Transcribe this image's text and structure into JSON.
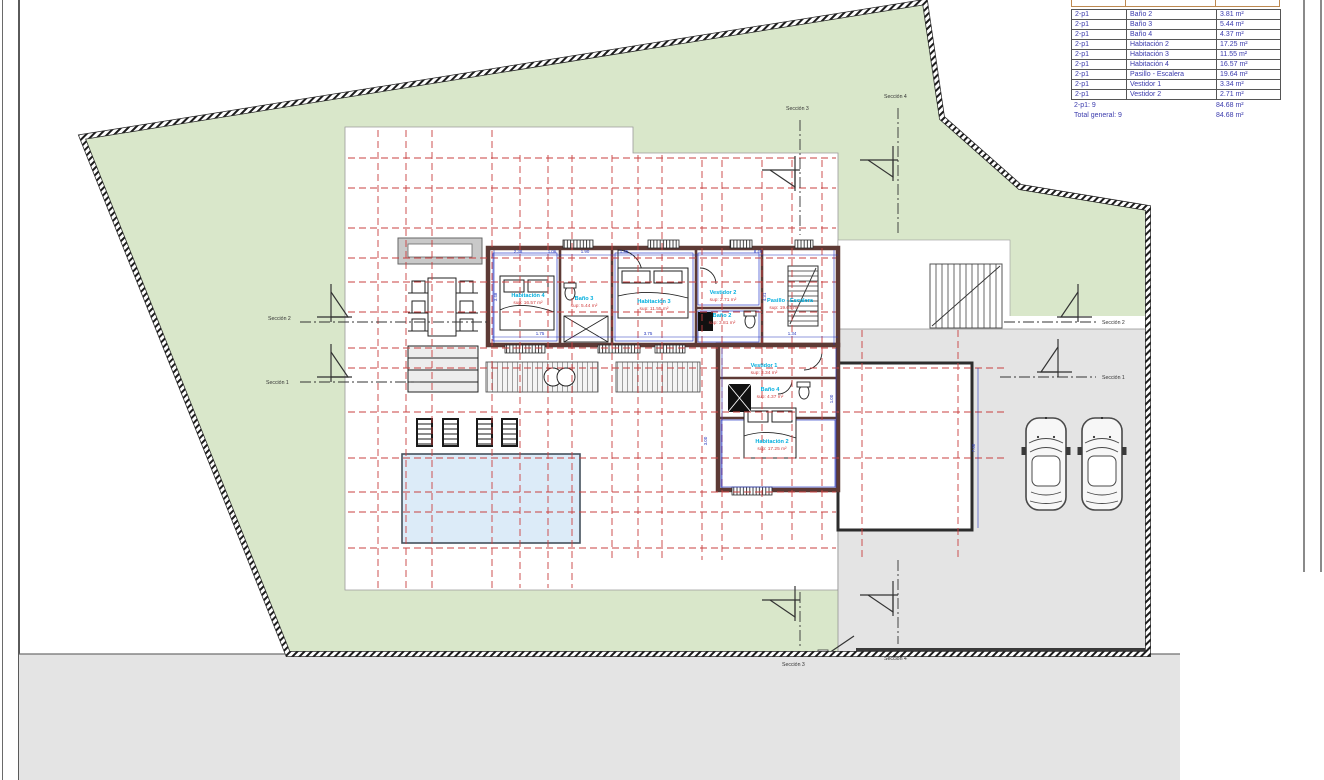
{
  "title": "Planta piso - plano de superficies",
  "colors": {
    "grass": "#d9e7ca",
    "pavement": "#e4e4e4",
    "pool": "#dcebf8",
    "wall": "#5d3a35",
    "grid_red": "#c94040",
    "dim_blue": "#2233bb",
    "room_name": "#00aede",
    "room_sup": "#d13c3c",
    "table_text": "#3b3bad"
  },
  "area_table": {
    "rows": [
      [
        "2-p1",
        "Baño 2",
        "3.81 m²"
      ],
      [
        "2-p1",
        "Baño 3",
        "5.44 m²"
      ],
      [
        "2-p1",
        "Baño 4",
        "4.37 m²"
      ],
      [
        "2-p1",
        "Habitación 2",
        "17.25 m²"
      ],
      [
        "2-p1",
        "Habitación 3",
        "11.55 m²"
      ],
      [
        "2-p1",
        "Habitación 4",
        "16.57 m²"
      ],
      [
        "2-p1",
        "Pasillo - Escalera",
        "19.64 m²"
      ],
      [
        "2-p1",
        "Vestidor 1",
        "3.34 m²"
      ],
      [
        "2-p1",
        "Vestidor 2",
        "2.71 m²"
      ]
    ],
    "summary": [
      {
        "label": "2-p1: 9",
        "value": "84.68 m²"
      },
      {
        "label": "Total general: 9",
        "value": "84.68 m²"
      }
    ]
  },
  "rooms": [
    {
      "name": "Habitación 4",
      "sup": "sup: 16.57 m²"
    },
    {
      "name": "Baño 3",
      "sup": "sup: 5.44 m²"
    },
    {
      "name": "Habitación 3",
      "sup": "sup: 11.55 m²"
    },
    {
      "name": "Vestidor 2",
      "sup": "sup: 2.71 m²"
    },
    {
      "name": "Baño 2",
      "sup": "sup: 3.81 m²"
    },
    {
      "name": "Pasillo - Escalera",
      "sup": "sup: 19.64 m²"
    },
    {
      "name": "Vestidor 1",
      "sup": "sup: 3.34 m²"
    },
    {
      "name": "Baño 4",
      "sup": "sup: 4.37 m²"
    },
    {
      "name": "Habitación 2",
      "sup": "sup: 17.25 m²"
    }
  ],
  "sections": {
    "s1": "Sección 1",
    "s2": "Sección 2",
    "s3": "Sección 3",
    "s4": "Sección 4"
  },
  "dims": {
    "top": [
      "2.38",
      "1.06",
      "1.90",
      "1.95",
      "8.40"
    ],
    "bottom": [
      "1.75",
      "3.75",
      "1.34"
    ],
    "left": [
      "3.48"
    ],
    "right": [
      "4.31"
    ],
    "wing": [
      "3.00",
      "1.00"
    ],
    "garage": [
      "7.60"
    ]
  }
}
